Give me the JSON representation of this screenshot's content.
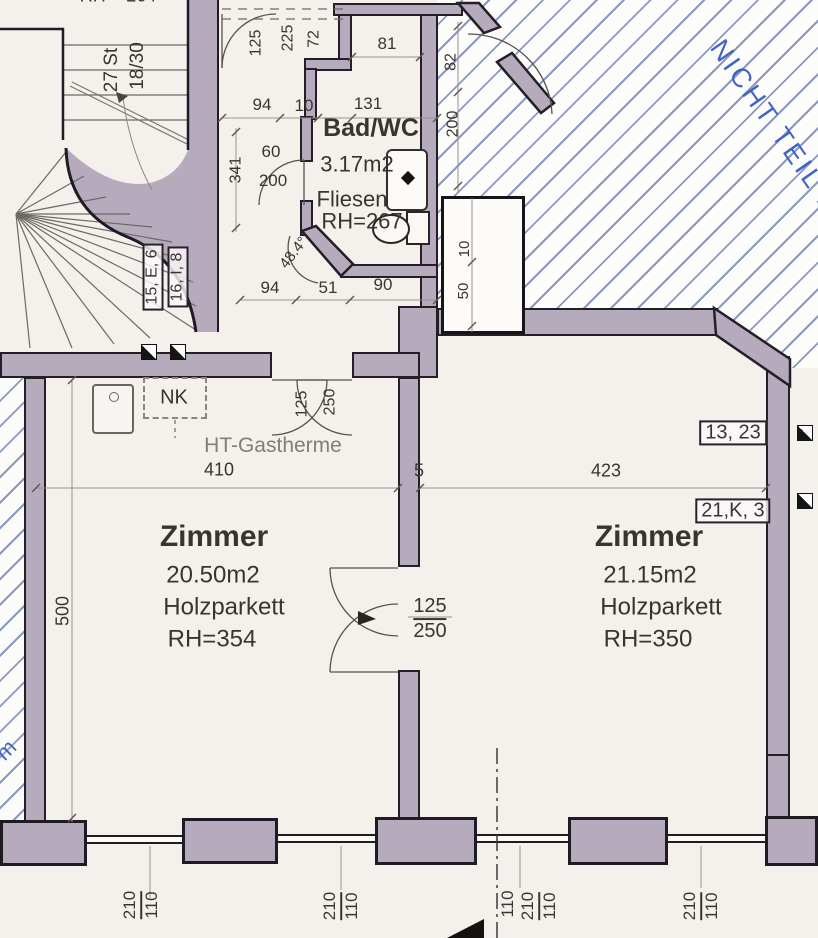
{
  "plan_title": "Wohnungsplan (Grundriss-Ausschnitt)",
  "colors": {
    "wall": "#b5abbd",
    "outline": "#241f26",
    "hatch_line": "#8a99bd",
    "paper": "#f4f1ec",
    "text": "#3a3430",
    "blue_annotation": "#3f63c6",
    "dim_line": "#99928b"
  },
  "rooms": [
    {
      "name": "Zimmer",
      "area": "20.50m2",
      "floor": "Holzparkett",
      "height": "RH=354"
    },
    {
      "name": "Zimmer",
      "area": "21.15m2",
      "floor": "Holzparkett",
      "height": "RH=350"
    },
    {
      "name": "Bad/WC",
      "area": "3.17m2",
      "floor": "Fliesen",
      "height": "RH=267"
    }
  ],
  "stair_note": "27 St 18/30",
  "not_part_note": "NICHT TEIL D",
  "labels": [
    {
      "n": "stair-height-note",
      "t": "RH = 264",
      "x": 118,
      "y": -4,
      "s": 18
    },
    {
      "n": "stair-count",
      "t": "27 St",
      "x": 112,
      "y": 70,
      "r": -90,
      "s": 19
    },
    {
      "n": "stair-ratio",
      "t": "18/30",
      "x": 138,
      "y": 66,
      "r": -90,
      "s": 19
    },
    {
      "t": "125",
      "x": 257,
      "y": 43,
      "r": -90,
      "s": 16
    },
    {
      "t": "225",
      "x": 289,
      "y": 38,
      "r": -90,
      "s": 16
    },
    {
      "t": "72",
      "x": 315,
      "y": 39,
      "r": -90,
      "s": 16
    },
    {
      "t": "81",
      "x": 387,
      "y": 44,
      "s": 17
    },
    {
      "t": "94",
      "x": 262,
      "y": 105,
      "s": 17
    },
    {
      "t": "10",
      "x": 304,
      "y": 106,
      "s": 17
    },
    {
      "t": "131",
      "x": 368,
      "y": 104,
      "s": 17
    },
    {
      "t": "341",
      "x": 237,
      "y": 170,
      "r": -90,
      "s": 16
    },
    {
      "t": "60",
      "x": 271,
      "y": 152,
      "s": 17
    },
    {
      "t": "200",
      "x": 273,
      "y": 181,
      "s": 17
    },
    {
      "t": "82",
      "x": 452,
      "y": 62,
      "r": -90,
      "s": 16
    },
    {
      "t": "200",
      "x": 454,
      "y": 124,
      "r": -90,
      "s": 16
    },
    {
      "n": "bath-title",
      "t": "Bad/WC",
      "x": 371,
      "y": 128,
      "s": 25,
      "b": 1
    },
    {
      "n": "bath-area",
      "t": "3.17m2",
      "x": 357,
      "y": 164,
      "s": 22
    },
    {
      "n": "bath-floor",
      "t": "Fliesen",
      "x": 352,
      "y": 199,
      "s": 22
    },
    {
      "n": "bath-height",
      "t": "RH=267",
      "x": 362,
      "y": 221,
      "s": 22
    },
    {
      "n": "wall-angle",
      "t": "48.4°",
      "x": 294,
      "y": 253,
      "r": -52,
      "s": 15
    },
    {
      "t": "94",
      "x": 270,
      "y": 288,
      "s": 17
    },
    {
      "t": "51",
      "x": 328,
      "y": 288,
      "s": 17
    },
    {
      "t": "90",
      "x": 383,
      "y": 285,
      "s": 17
    },
    {
      "t": "10",
      "x": 465,
      "y": 249,
      "r": -90,
      "s": 15
    },
    {
      "t": "50",
      "x": 464,
      "y": 291,
      "r": -90,
      "s": 15
    },
    {
      "n": "door-tag",
      "t": "15, E, 6",
      "x": 153,
      "y": 277,
      "r": -90,
      "s": 16,
      "box": 1
    },
    {
      "n": "door-tag",
      "t": "16, I, 8",
      "x": 178,
      "y": 277,
      "r": -90,
      "s": 16,
      "box": 1
    },
    {
      "n": "not-part-note",
      "t": "NICHT TEIL D",
      "x": 776,
      "y": 128,
      "r": 55,
      "s": 27,
      "c": "#3f63c6",
      "sp": 3
    },
    {
      "n": "niche-label",
      "t": "NK",
      "x": 174,
      "y": 398,
      "s": 20
    },
    {
      "n": "boiler-label",
      "t": "HT-Gastherme",
      "x": 273,
      "y": 446,
      "s": 21,
      "c": "#827d76"
    },
    {
      "t": "410",
      "x": 219,
      "y": 470,
      "s": 18
    },
    {
      "t": "5",
      "x": 419,
      "y": 471,
      "s": 18
    },
    {
      "t": "423",
      "x": 606,
      "y": 471,
      "s": 18
    },
    {
      "n": "room-tag",
      "t": "13, 23",
      "x": 733,
      "y": 433,
      "s": 20,
      "box": 1
    },
    {
      "n": "room-tag",
      "t": "21,K, 3",
      "x": 733,
      "y": 511,
      "s": 20,
      "box": 1
    },
    {
      "t": "125",
      "x": 303,
      "y": 404,
      "r": -90,
      "s": 16
    },
    {
      "t": "250",
      "x": 331,
      "y": 402,
      "r": -90,
      "s": 16
    },
    {
      "n": "room1-title",
      "t": "Zimmer",
      "x": 214,
      "y": 537,
      "s": 30,
      "b": 1
    },
    {
      "n": "room1-area",
      "t": "20.50m2",
      "x": 213,
      "y": 575,
      "s": 24
    },
    {
      "n": "room1-floor",
      "t": "Holzparkett",
      "x": 224,
      "y": 607,
      "s": 24
    },
    {
      "n": "room1-height",
      "t": "RH=354",
      "x": 212,
      "y": 639,
      "s": 24
    },
    {
      "n": "room2-title",
      "t": "Zimmer",
      "x": 649,
      "y": 537,
      "s": 30,
      "b": 1
    },
    {
      "n": "room2-area",
      "t": "21.15m2",
      "x": 650,
      "y": 575,
      "s": 24
    },
    {
      "n": "room2-floor",
      "t": "Holzparkett",
      "x": 661,
      "y": 607,
      "s": 24
    },
    {
      "n": "room2-height",
      "t": "RH=350",
      "x": 648,
      "y": 639,
      "s": 24
    },
    {
      "t": "500",
      "x": 63,
      "y": 611,
      "r": -90,
      "s": 18
    },
    {
      "n": "door-size",
      "t": "125",
      "t2": "250",
      "x": 430,
      "y": 619,
      "s": 20
    },
    {
      "t": "110",
      "x": 508,
      "y": 904,
      "r": -90,
      "s": 17
    },
    {
      "n": "window-size",
      "t": "210",
      "t2": "110",
      "x": 141,
      "y": 905,
      "r": -90,
      "s": 17
    },
    {
      "n": "window-size",
      "t": "210",
      "t2": "110",
      "x": 341,
      "y": 906,
      "r": -90,
      "s": 17
    },
    {
      "n": "window-size",
      "t": "210",
      "t2": "110",
      "x": 539,
      "y": 906,
      "r": -90,
      "s": 17
    },
    {
      "n": "window-size",
      "t": "210",
      "t2": "110",
      "x": 701,
      "y": 906,
      "r": -90,
      "s": 17
    },
    {
      "n": "blue-mark",
      "t": "m",
      "x": 6,
      "y": 750,
      "r": -45,
      "s": 22,
      "c": "#3f63c6"
    }
  ]
}
